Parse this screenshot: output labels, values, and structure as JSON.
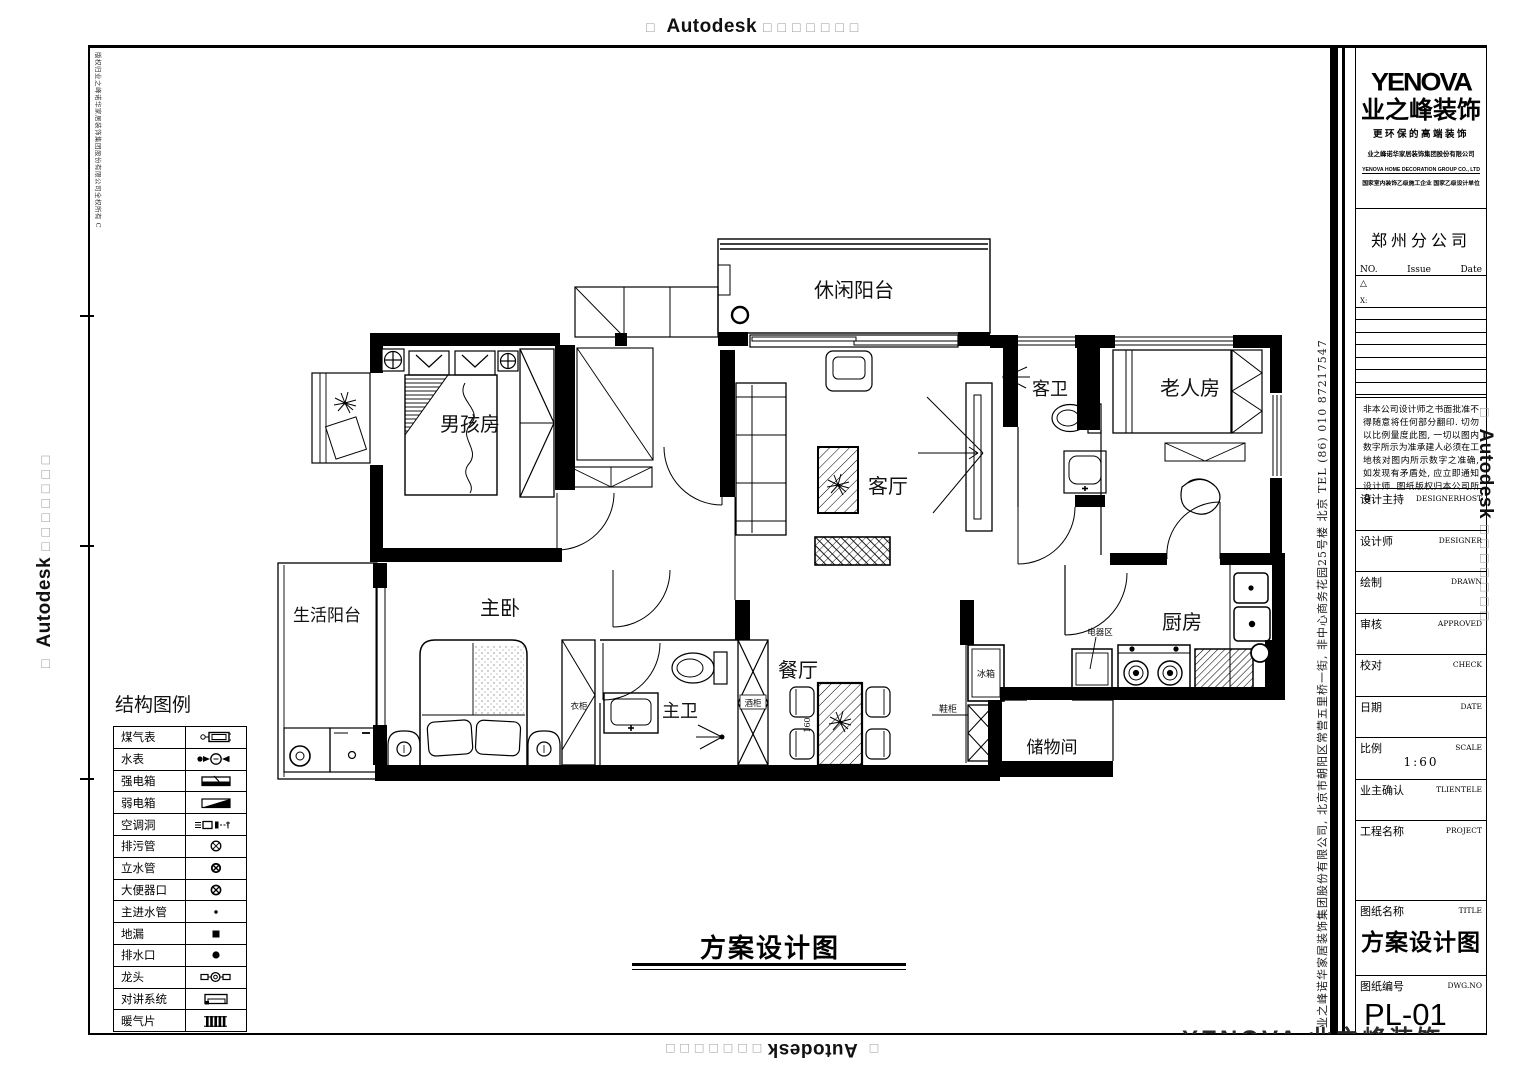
{
  "watermark": {
    "brand": "Autodesk",
    "box": "□",
    "boxes7": "□□□□□□□"
  },
  "border": {
    "copyright_vertical": "版权归业之峰诺华家居装饰集团股份有限公司全权所有  C",
    "address_vertical": "业之峰诺华家居装饰集团股份有限公司, 北京市朝阳区常营五里桥一街, 非中心商务花园25号楼    北京    TEL    (86)  010  87217547"
  },
  "legend": {
    "title": "结构图例",
    "items": [
      {
        "label": "煤气表",
        "symbol": "gas-meter"
      },
      {
        "label": "水表",
        "symbol": "water-meter"
      },
      {
        "label": "强电箱",
        "symbol": "strong-electric-box"
      },
      {
        "label": "弱电箱",
        "symbol": "weak-electric-box"
      },
      {
        "label": "空调洞",
        "symbol": "ac-hole"
      },
      {
        "label": "排污管",
        "symbol": "sewage-pipe"
      },
      {
        "label": "立水管",
        "symbol": "riser-pipe"
      },
      {
        "label": "大便器口",
        "symbol": "toilet-outlet"
      },
      {
        "label": "主进水管",
        "symbol": "main-water-inlet"
      },
      {
        "label": "地漏",
        "symbol": "floor-drain"
      },
      {
        "label": "排水口",
        "symbol": "drain-outlet"
      },
      {
        "label": "龙头",
        "symbol": "faucet"
      },
      {
        "label": "对讲系统",
        "symbol": "intercom"
      },
      {
        "label": "暖气片",
        "symbol": "radiator"
      }
    ]
  },
  "plan": {
    "rooms": {
      "leisure_balcony": "休闲阳台",
      "boys_room": "男孩房",
      "living_room": "客厅",
      "guest_bath": "客卫",
      "elder_room": "老人房",
      "life_balcony": "生活阳台",
      "master_bedroom": "主卧",
      "master_bath": "主卫",
      "dining_room": "餐厅",
      "kitchen": "厨房",
      "storage": "储物间"
    },
    "annotations": {
      "wardrobe": "衣柜",
      "wine_cabinet": "酒柜",
      "appliance_area": "电器区",
      "fridge": "冰箱",
      "shoe_cabinet": "鞋柜",
      "dim": "160"
    },
    "caption": "方案设计图"
  },
  "titleblock": {
    "brand": {
      "logo": "YENOVA",
      "name": "业之峰装饰",
      "slogan": "更环保的高端装饰",
      "company_cn": "业之峰诺华家居装饰集团股份有限公司",
      "company_en": "YENOVA HOME DECORATION GROUP CO., LTD",
      "certs": "国家室内装饰乙级施工企业 国家乙级设计单位"
    },
    "branch": "郑州分公司",
    "revision": {
      "no": "NO.",
      "issue": "Issue",
      "date": "Date",
      "marker": "△",
      "x_label": "X:"
    },
    "disclaimer": "非本公司设计师之书面批准不得随意将任何部分翻印. 切勿以比例量度此图, 一切以图内数字所示为准承建人必须在工地核对图内所示数字之准确, 如发现有矛盾处, 应立即通知设计师. 图纸版权归本公司所有.",
    "fields": [
      {
        "cn": "设计主持",
        "en": "DESIGNERHOST"
      },
      {
        "cn": "设计师",
        "en": "DESIGNER"
      },
      {
        "cn": "绘制",
        "en": "DRAWN"
      },
      {
        "cn": "审核",
        "en": "APPROVED"
      },
      {
        "cn": "校对",
        "en": "CHECK"
      },
      {
        "cn": "日期",
        "en": "DATE"
      },
      {
        "cn": "比例",
        "en": "SCALE"
      },
      {
        "cn": "业主确认",
        "en": "TLIENTELE"
      },
      {
        "cn": "工程名称",
        "en": "PROJECT"
      },
      {
        "cn": "图纸名称",
        "en": "TITLE"
      },
      {
        "cn": "图纸编号",
        "en": "DWG.NO"
      }
    ],
    "scale_value": "1:60",
    "sheet_title": "方案设计图",
    "dwg_no": "PL-01",
    "side_brand": "Autodesk",
    "cut_watermark": "YENOVA 业之峰装饰"
  }
}
